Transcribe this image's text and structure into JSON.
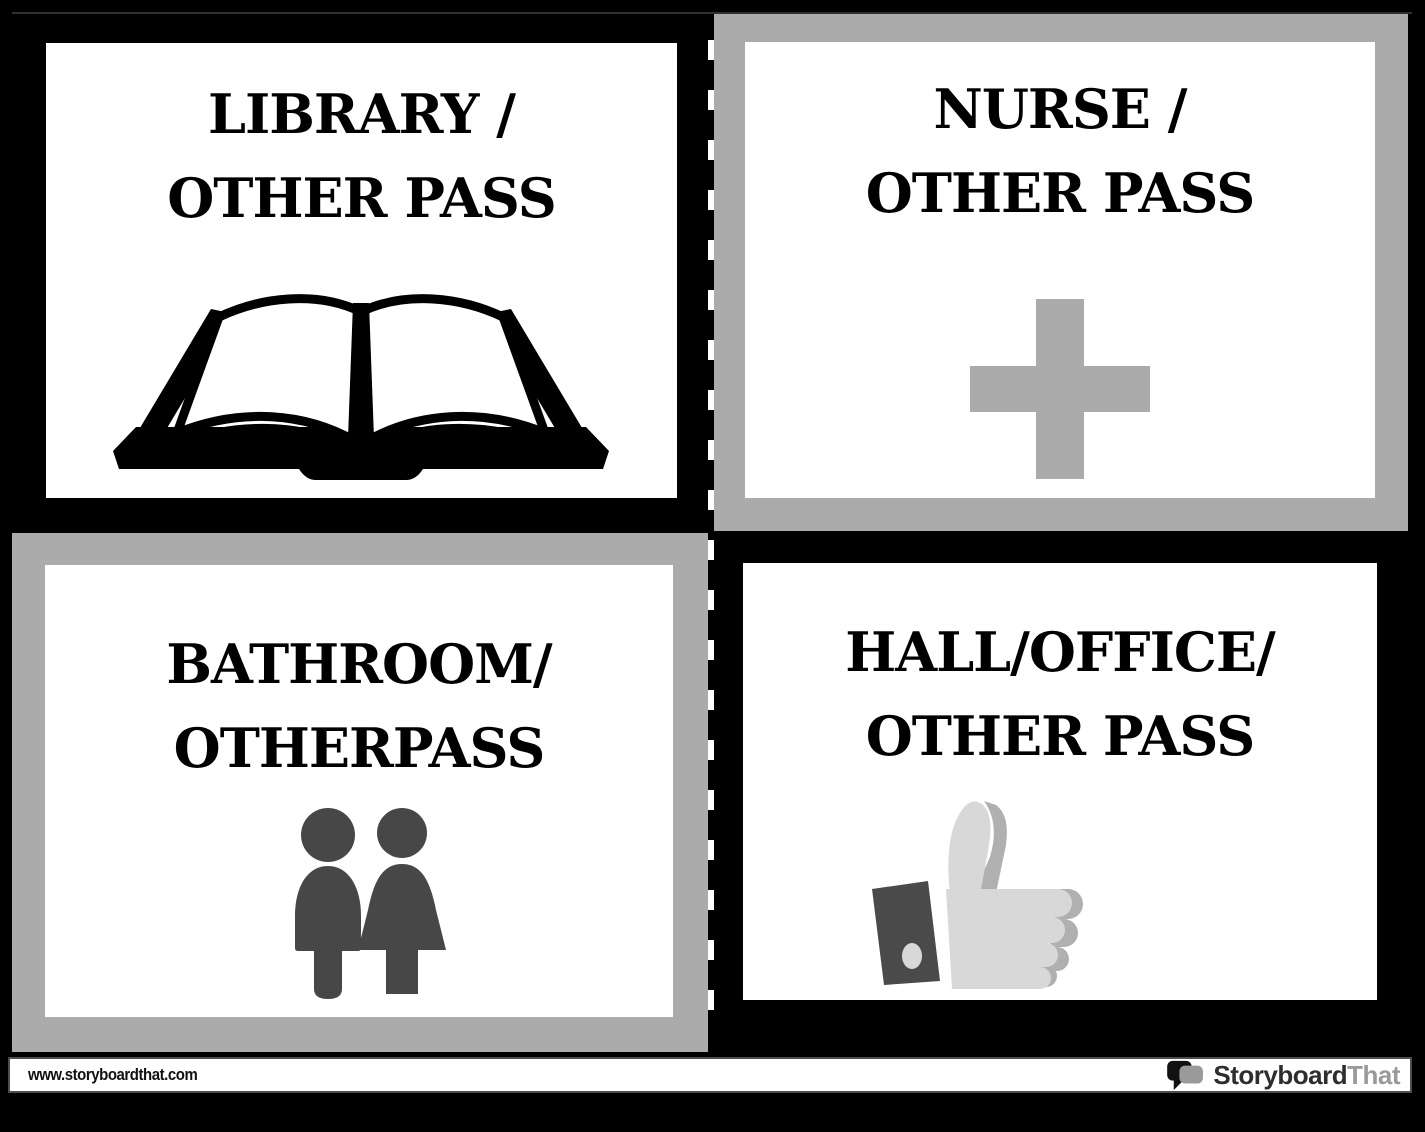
{
  "cards": [
    {
      "id": "library",
      "line1": "LIBRARY /",
      "line2": "OTHER PASS",
      "icon": "open-book-icon",
      "frame_color": "#000000"
    },
    {
      "id": "nurse",
      "line1": "NURSE /",
      "line2": "OTHER PASS",
      "icon": "medical-cross-icon",
      "frame_color": "#ABABAB"
    },
    {
      "id": "bathroom",
      "line1": "BATHROOM/",
      "line2": "OTHERPASS",
      "icon": "restroom-people-icon",
      "frame_color": "#ABABAB"
    },
    {
      "id": "hall",
      "line1": "HALL/OFFICE/",
      "line2": "OTHER PASS",
      "icon": "thumbs-up-icon",
      "frame_color": "#000000"
    }
  ],
  "footer": {
    "url": "www.storyboardthat.com",
    "logo_primary": "Storyboard",
    "logo_secondary": "That"
  },
  "colors": {
    "background": "#000000",
    "frame_silver": "#ABABAB",
    "icon_dark_gray": "#474747",
    "icon_light_gray": "#D8D8D8",
    "icon_mid_gray": "#B0B0B0",
    "title_text": "#000000",
    "logo_gray": "#9A9A9A"
  }
}
